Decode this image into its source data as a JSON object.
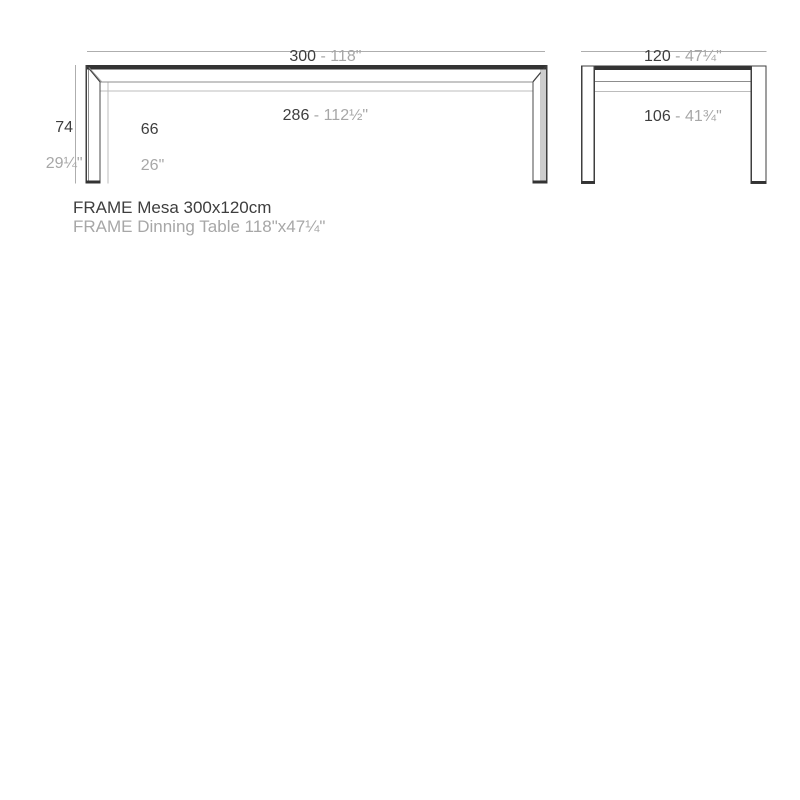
{
  "front_view": {
    "top_dim_cm": "300",
    "top_dim_in": " - 118\"",
    "inner_dim_cm": "286",
    "inner_dim_in": " - 112½\"",
    "height_cm": "74",
    "height_in": "29¼\"",
    "inner_height_cm": "66",
    "inner_height_in": "26\""
  },
  "side_view": {
    "top_dim_cm": "120",
    "top_dim_in": " - 47¼\"",
    "inner_dim_cm": "106",
    "inner_dim_in": " - 41¾\""
  },
  "caption": {
    "line1": "FRAME Mesa 300x120cm",
    "line2": "FRAME Dinning Table 118\"x47¼\""
  },
  "colors": {
    "text_dark": "#3e3e3e",
    "text_light": "#a7a7a7",
    "line_dark": "#3f3f3f",
    "line_medium": "#8d8d8d",
    "line_light": "#bcbcbc",
    "dimension_line": "#aeaeae",
    "top_edge": "#333333",
    "leg_shade": "#cdcdcd"
  }
}
